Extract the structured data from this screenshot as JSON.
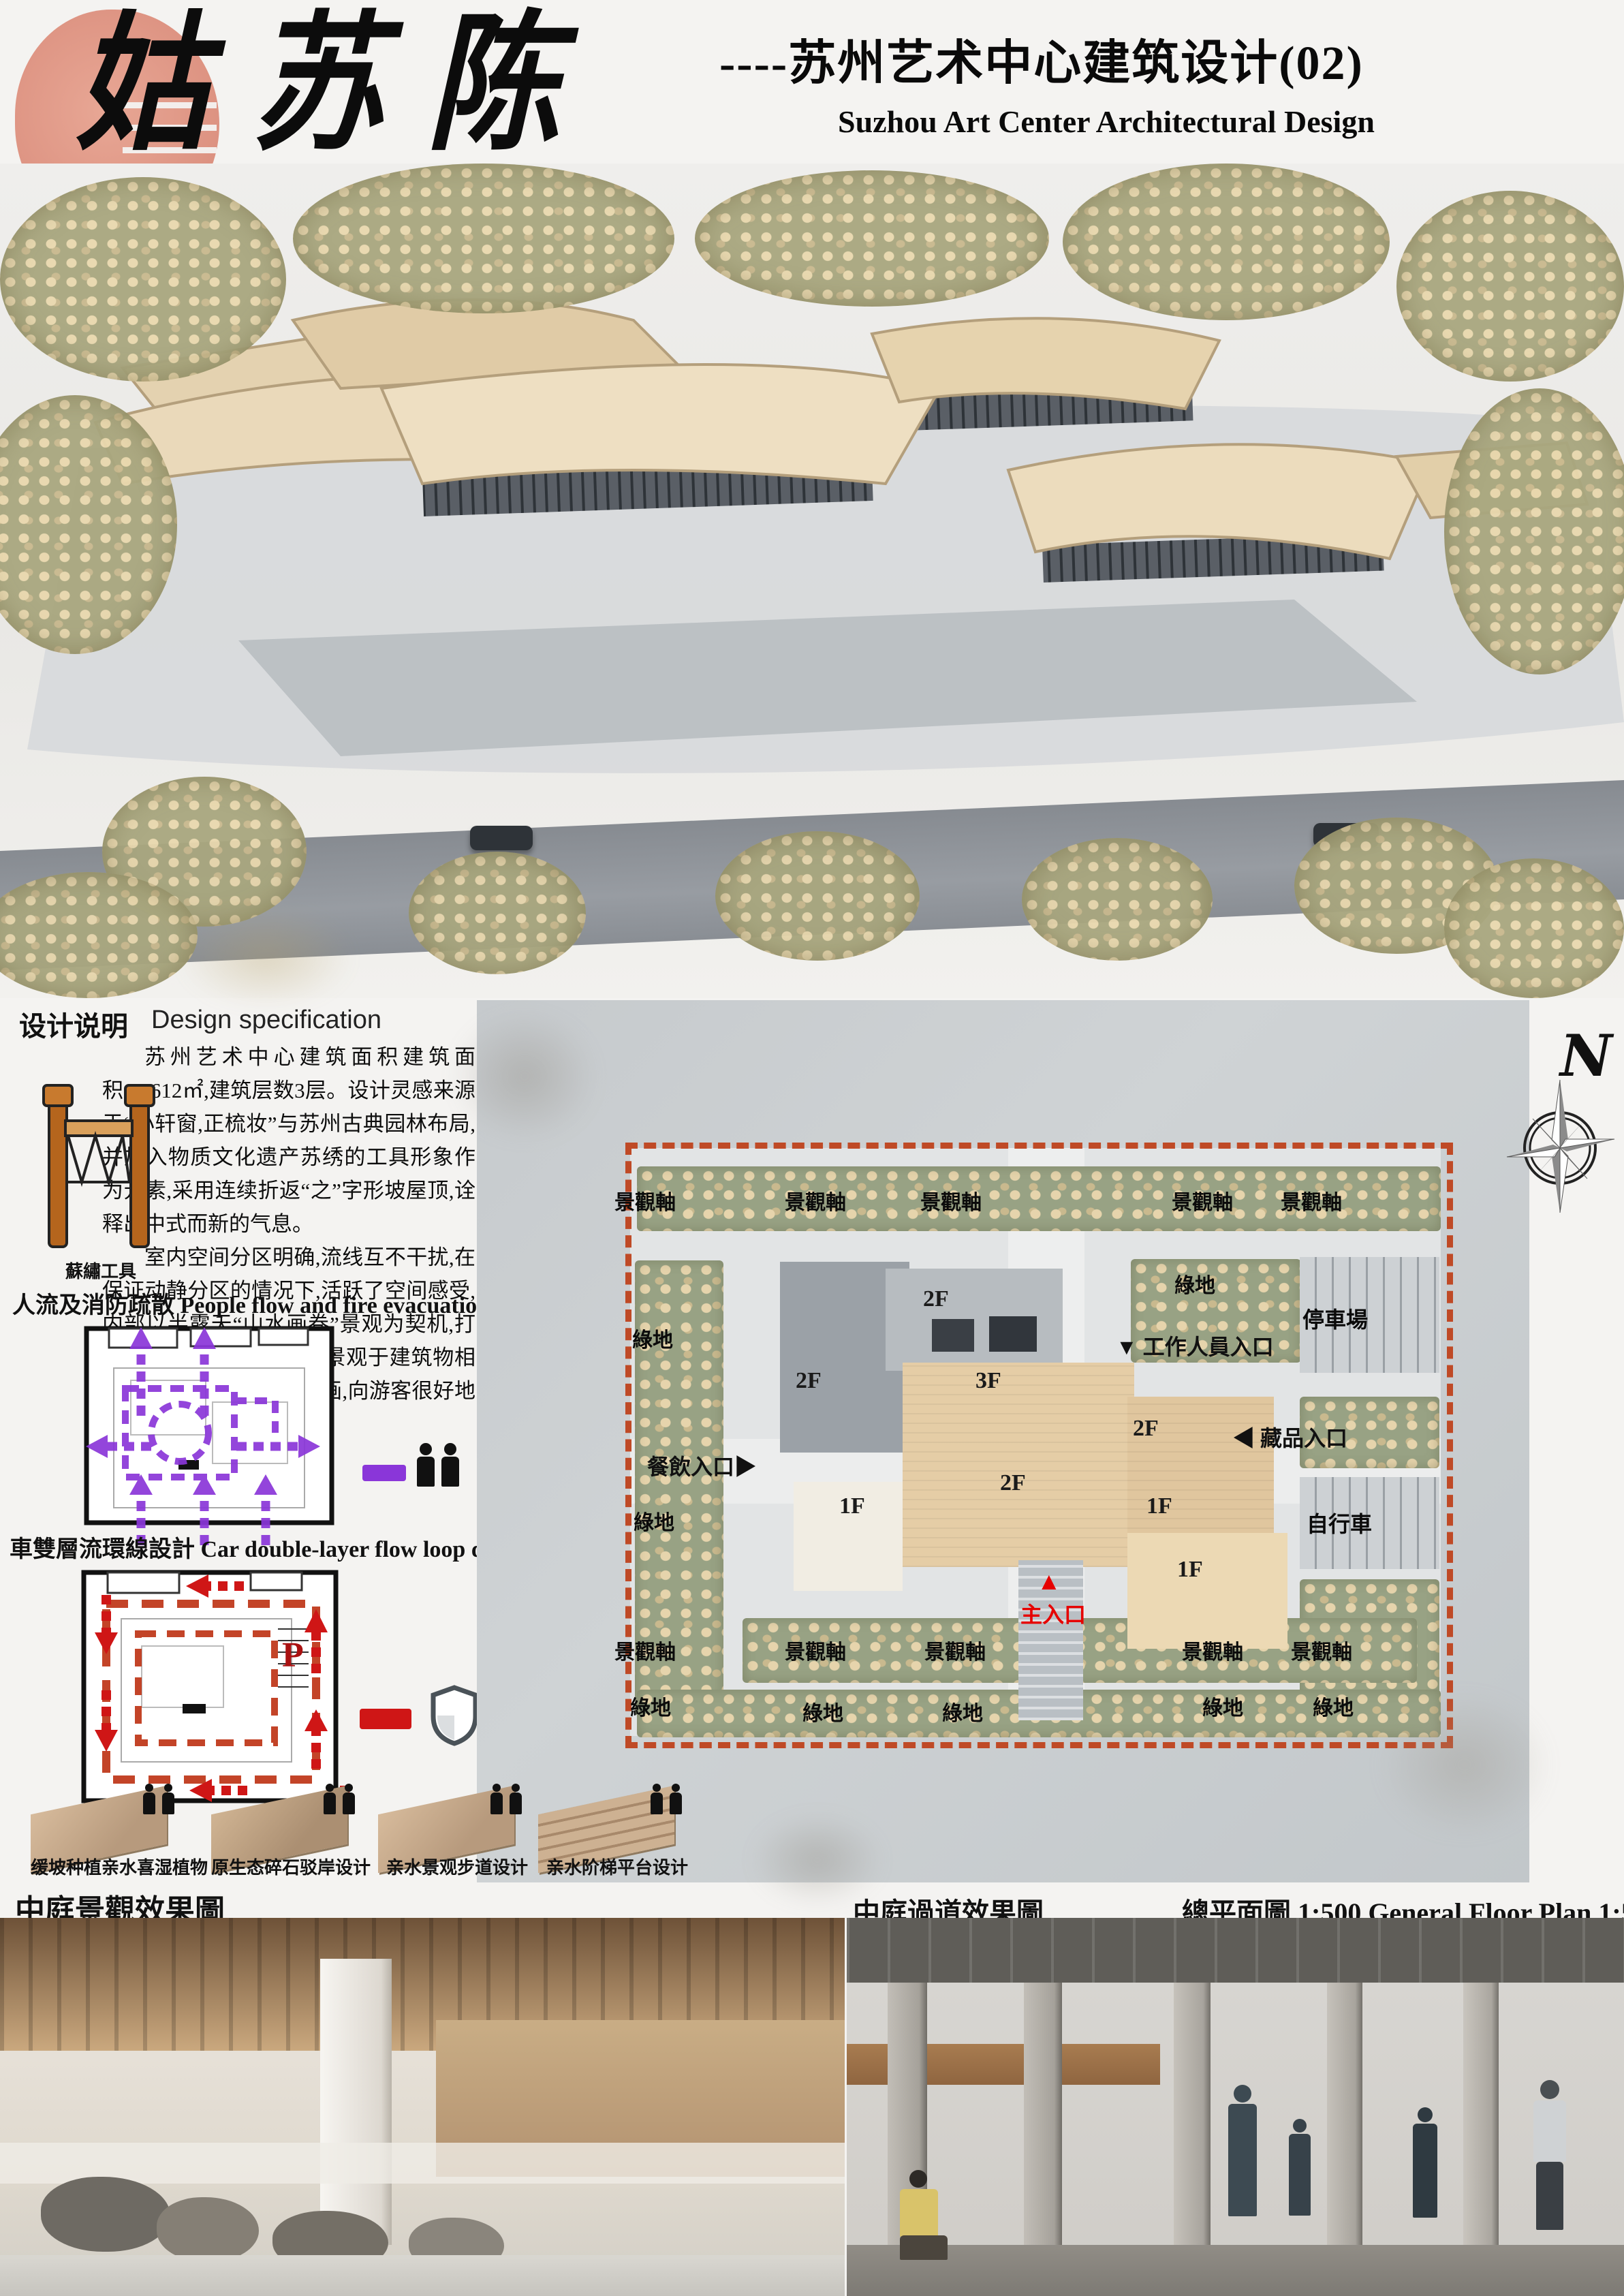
{
  "header": {
    "title_calligraphy": "姑苏陈情",
    "title_cn": "----苏州艺术中心建筑设计(02)",
    "title_en": "Suzhou Art Center Architectural Design"
  },
  "design_spec": {
    "heading_cn": "设计说明",
    "heading_en": "Design specification",
    "para1": "苏州艺术中心建筑面积建筑面积:10612㎡,建筑层数3层。设计灵感来源于“小轩窗,正梳妆”与苏州古典园林布局,并加入物质文化遗产苏绣的工具形象作为元素,采用连续折返“之”字形坡屋顶,诠释出中式而新的气息。",
    "para2": "室内空间分区明确,流线互不干扰,在保证动静分区的情况下,活跃了空间感受,内部以半露天“山水画卷”景观为契机,打造出苏式园林意匠,外部景观于建筑物相得益彰,犹如一幅中国古画,向游客很好地展示文化底蕴。",
    "tool_label": "蘇繡工具"
  },
  "flow_diagram": {
    "heading_cn": "人流及消防疏散",
    "heading_en": "People flow and fire evacuation",
    "color": "#8a36d9"
  },
  "car_diagram": {
    "heading_cn": "車雙層流環線設計",
    "heading_en": "Car double-layer flow loop design",
    "parking_letter": "P",
    "color": "#c03a1d"
  },
  "site_plan": {
    "north_label": "N",
    "landscape_axis": "景觀軸",
    "green_space": "綠地",
    "parking_lot": "停車場",
    "bicycle": "自行車",
    "staff_entrance": "▼ 工作人員入口",
    "collection_entrance": "◀ 藏品入口",
    "dining_entrance": "餐飲入口▶",
    "main_entrance_arrow": "▲",
    "main_entrance": "主入口",
    "floors": {
      "f1": "1F",
      "f2": "2F",
      "f3": "3F"
    }
  },
  "eco_sections": [
    {
      "label": "缓坡种植亲水喜湿植物"
    },
    {
      "label": "原生态碎石驳岸设计"
    },
    {
      "label": "亲水景观步道设计"
    },
    {
      "label": "亲水阶梯平台设计"
    }
  ],
  "captions": {
    "courtyard_view": "中庭景觀效果圖",
    "corridor_view": "中庭過道效果圖",
    "floor_plan": "總平面圖 1:500 General Floor Plan 1:500"
  },
  "colors": {
    "seal_pink": "#dd9181",
    "flow_purple": "#8a36d9",
    "loop_red": "#c03a1d",
    "entrance_red": "#e60000",
    "roof_beige": "#e7d6b6",
    "site_border": "#bf4a26"
  }
}
